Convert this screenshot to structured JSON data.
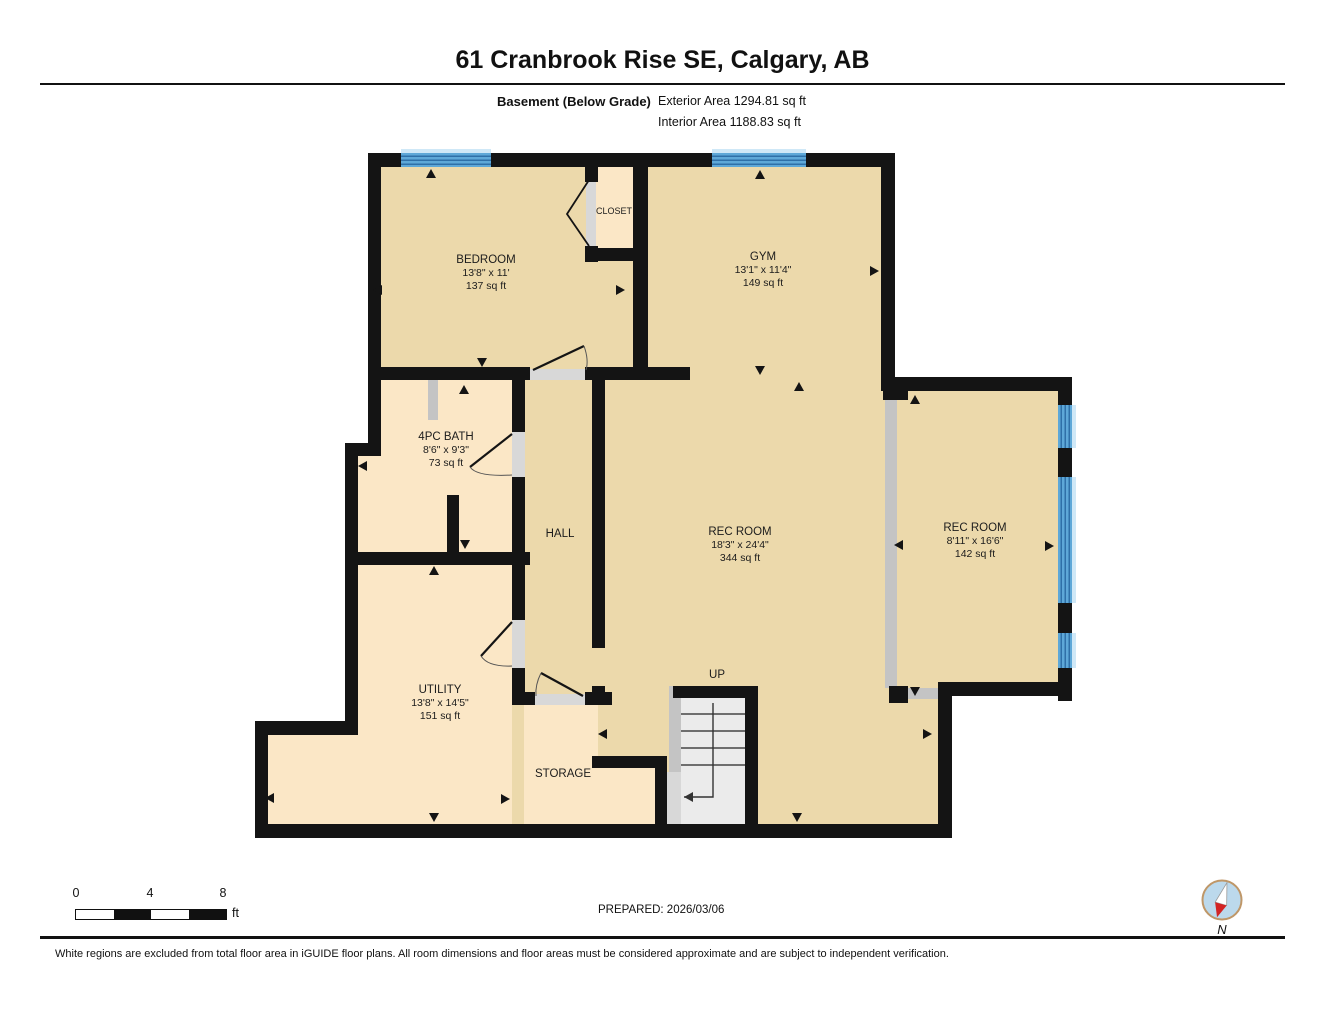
{
  "header": {
    "title": "61 Cranbrook Rise SE, Calgary, AB",
    "floor_label": "Basement (Below Grade)",
    "exterior_area": "Exterior Area 1294.81 sq ft",
    "interior_area": "Interior Area 1188.83 sq ft"
  },
  "rooms": {
    "bedroom": {
      "name": "BEDROOM",
      "dims": "13'8\" x 11'",
      "area": "137 sq ft"
    },
    "closet": {
      "name": "CLOSET"
    },
    "gym": {
      "name": "GYM",
      "dims": "13'1\" x 11'4\"",
      "area": "149 sq ft"
    },
    "bath": {
      "name": "4PC BATH",
      "dims": "8'6\" x 9'3\"",
      "area": "73 sq ft"
    },
    "hall": {
      "name": "HALL"
    },
    "rec_room": {
      "name": "REC ROOM",
      "dims": "18'3\" x 24'4\"",
      "area": "344 sq ft"
    },
    "rec_room_2": {
      "name": "REC ROOM",
      "dims": "8'11\" x 16'6\"",
      "area": "142 sq ft"
    },
    "utility": {
      "name": "UTILITY",
      "dims": "13'8\" x 14'5\"",
      "area": "151 sq ft"
    },
    "storage": {
      "name": "STORAGE"
    },
    "stairs": {
      "label": "UP"
    }
  },
  "scale": {
    "tick0": "0",
    "tick4": "4",
    "tick8": "8",
    "unit": "ft"
  },
  "footer": {
    "prepared": "PREPARED: 2026/03/06",
    "disclaimer": "White regions are excluded from total floor area in iGUIDE floor plans. All room dimensions and floor areas must be considered approximate and are subject to independent verification.",
    "compass_label": "N"
  },
  "colors": {
    "floor_tan": "#ecd9ab",
    "floor_light": "#fbe7c6",
    "wall": "#141414",
    "window_blue": "#5ea8d8",
    "window_pale": "#cfe8f7",
    "opening_gray": "#d8d8d8",
    "compass_red": "#d32424"
  }
}
